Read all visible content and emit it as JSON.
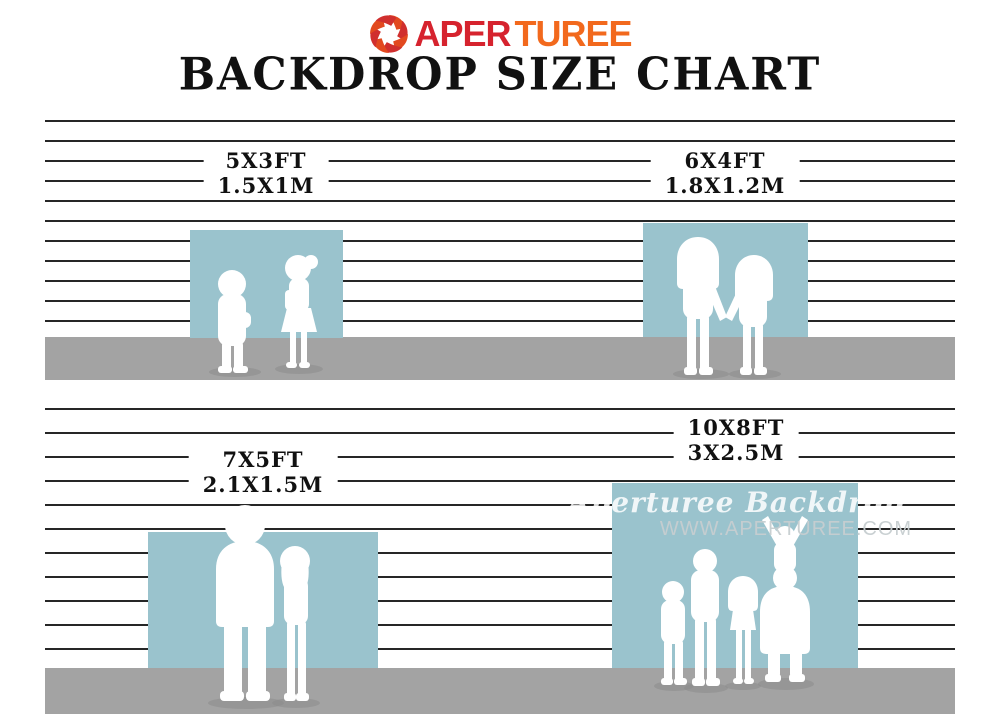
{
  "brand": {
    "logo_text_red": "APER",
    "logo_text_orange": "TUREE"
  },
  "title": "BACKDROP SIZE CHART",
  "sizes": [
    {
      "ft": "5X3FT",
      "m": "1.5X1M"
    },
    {
      "ft": "6X4FT",
      "m": "1.8X1.2M"
    },
    {
      "ft": "7X5FT",
      "m": "2.1X1.5M"
    },
    {
      "ft": "10X8FT",
      "m": "3X2.5M"
    }
  ],
  "watermark": {
    "script": "Aperturee Backdrop",
    "url": "WWW.APERTUREE.COM"
  },
  "colors": {
    "backdrop_blue": "#9ac3cd",
    "floor_gray": "#a3a3a3",
    "wall_line": "#262626",
    "logo_red": "#d6232e",
    "logo_orange": "#f2691d"
  }
}
